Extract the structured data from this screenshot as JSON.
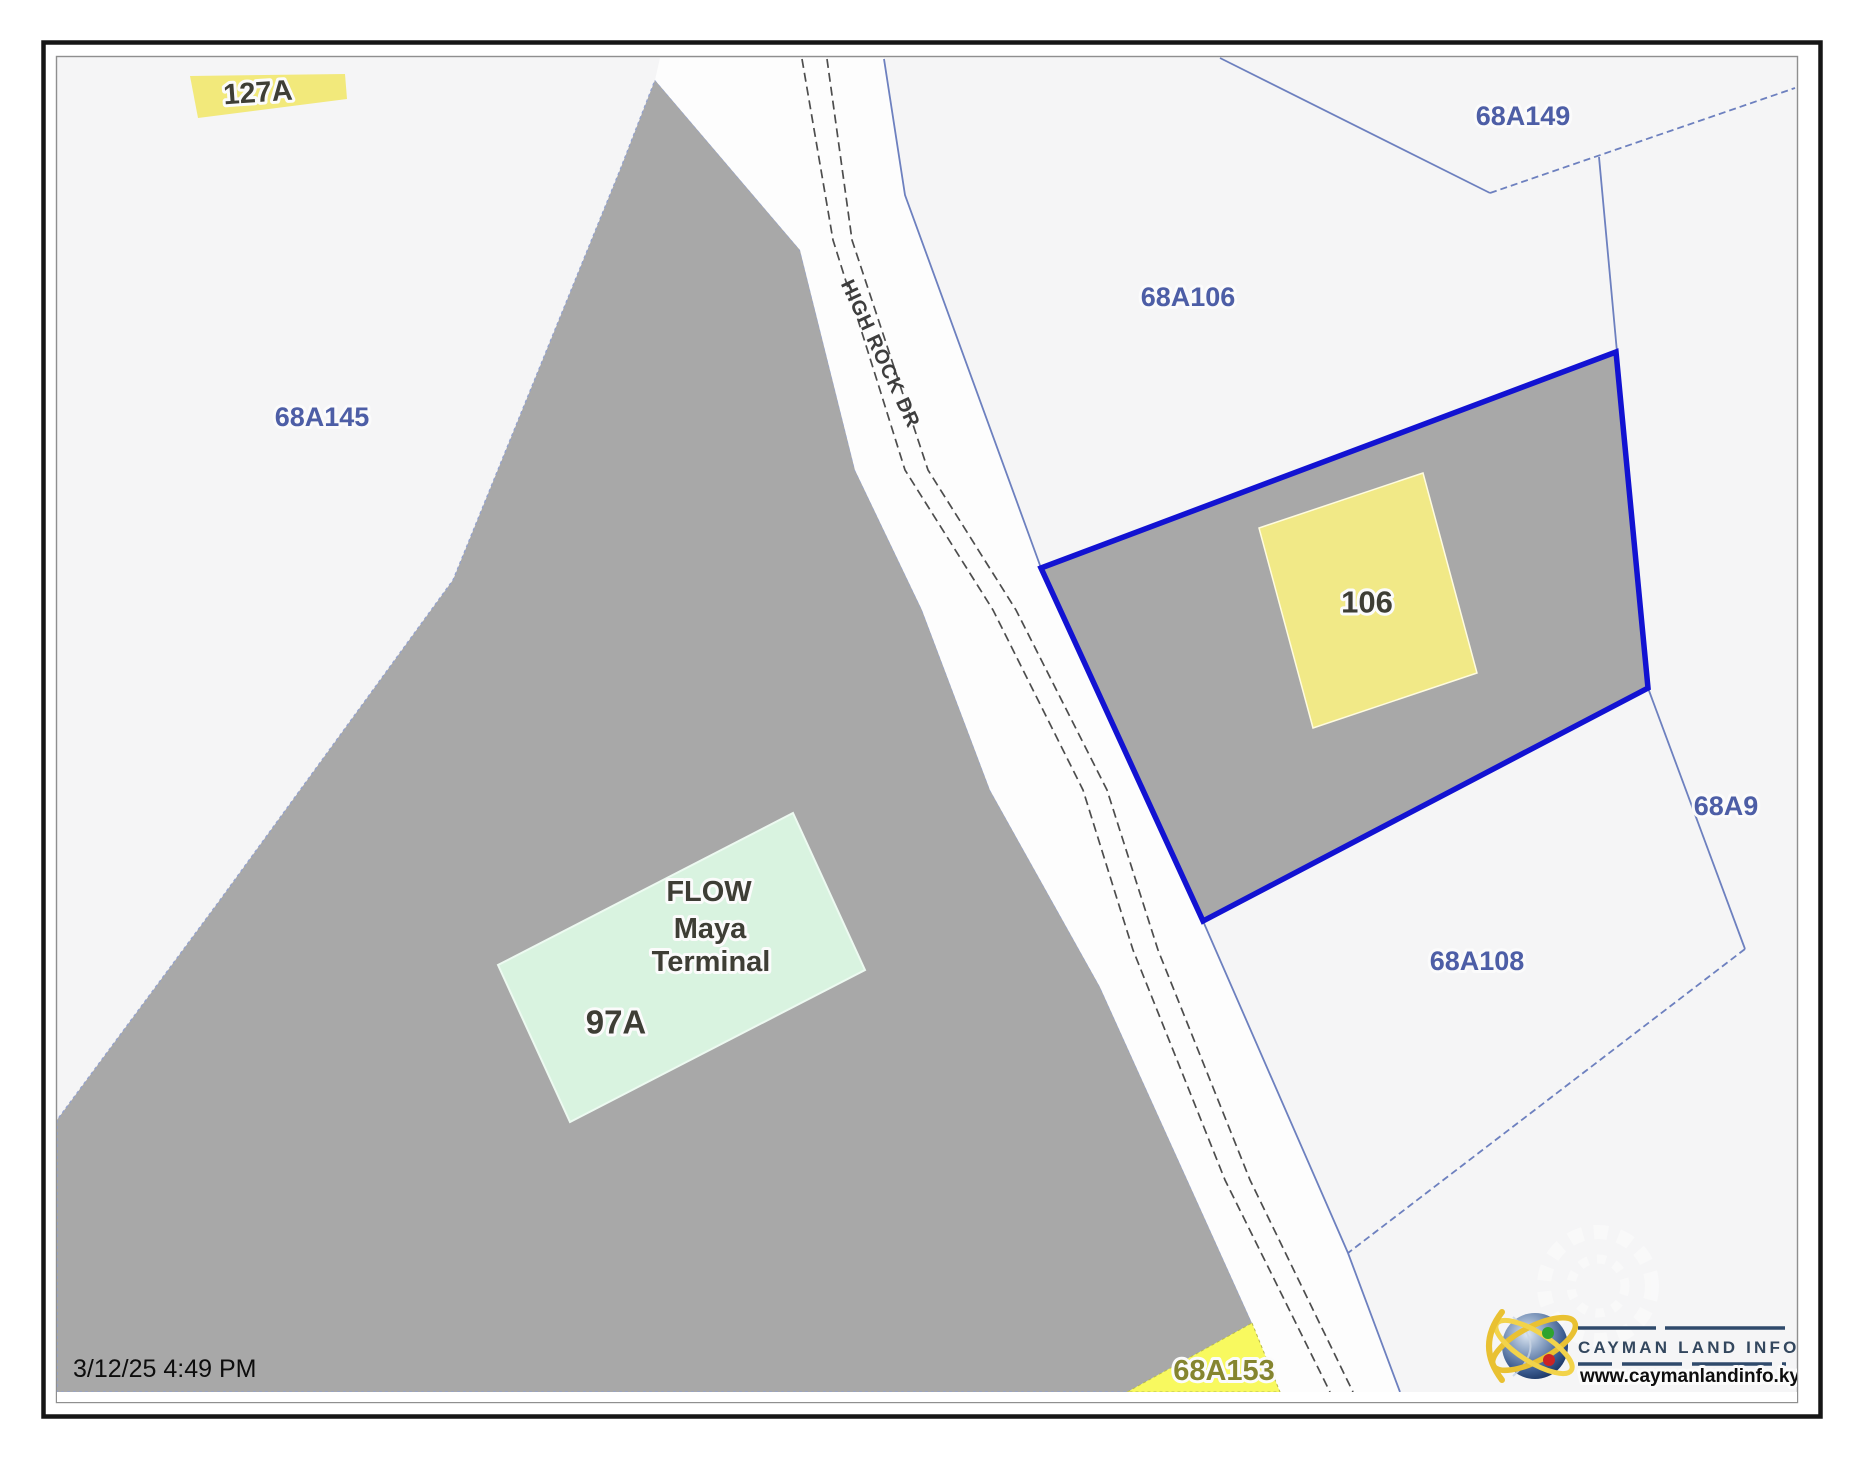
{
  "map": {
    "timestamp": "3/12/25 4:49 PM",
    "road": {
      "name": "HIGH ROCK DR"
    },
    "labels": {
      "parcel_127a": "127A",
      "parcel_68a145": "68A145",
      "parcel_68a106": "68A106",
      "parcel_68a149": "68A149",
      "parcel_68a9": "68A9",
      "parcel_68a108": "68A108",
      "parcel_68a153": "68A153",
      "subject_parcel": "106"
    },
    "buildings": {
      "flow_line1": "FLOW",
      "flow_line2": "Maya",
      "flow_line3": "Terminal",
      "flow_parcel": "97A"
    },
    "colors": {
      "map_background": "#f5f5f6",
      "parcel_gray": "#a8a8a8",
      "subject_outline_blue": "#1212d2",
      "building_yellow": "#f1e987",
      "road_highlight_yellow": "#f2e97b",
      "parcel_153_yellow": "#f8f95f",
      "building_green": "#d9f3e0",
      "boundary_blue": "#6d80bf",
      "label_blue": "#4d5ea6",
      "road_surface_white": "#fdfdfd"
    }
  },
  "logo": {
    "title": "CAYMAN LAND INFO",
    "url": "www.caymanlandinfo.ky"
  }
}
